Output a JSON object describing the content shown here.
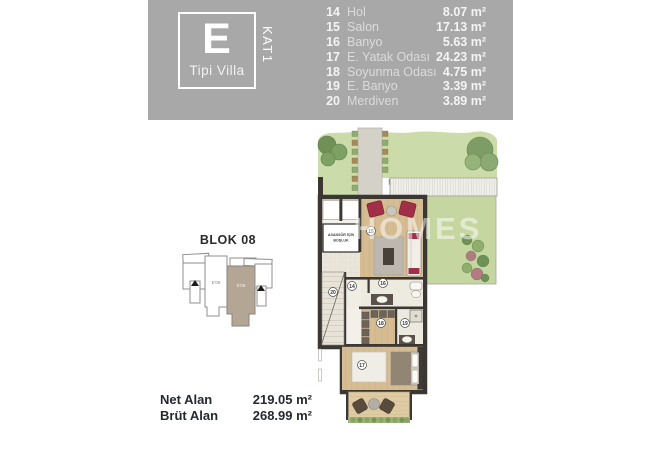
{
  "title_block": {
    "type_letter": "E",
    "type_label": "Tipi Villa",
    "floor_label": "KAT1"
  },
  "room_schedule": [
    {
      "no": "14",
      "name": "Hol",
      "area": "8.07 m²"
    },
    {
      "no": "15",
      "name": "Salon",
      "area": "17.13 m²"
    },
    {
      "no": "16",
      "name": "Banyo",
      "area": "5.63 m²"
    },
    {
      "no": "17",
      "name": "E. Yatak Odası",
      "area": "24.23 m²"
    },
    {
      "no": "18",
      "name": "Soyunma Odası",
      "area": "4.75 m²"
    },
    {
      "no": "19",
      "name": "E. Banyo",
      "area": "3.39 m²"
    },
    {
      "no": "20",
      "name": "Merdiven",
      "area": "3.89 m²"
    }
  ],
  "site_plan": {
    "title": "BLOK 08",
    "unit_label_left": "E'08",
    "unit_label_right": "E'08"
  },
  "area_summary": {
    "net_label": "Net Alan",
    "net_value": "219.05 m²",
    "brut_label": "Brüt Alan",
    "brut_value": "268.99 m²"
  },
  "floor_plan": {
    "elevator_note_line1": "ASANSÖR İÇİN",
    "elevator_note_line2": "BOŞLUK",
    "watermark": "HOMES",
    "markers": {
      "hol": "14",
      "salon": "15",
      "banyo": "16",
      "yatak": "17",
      "soyunma": "18",
      "ebanyo": "19",
      "merdiven": "20"
    }
  },
  "colors": {
    "banner_gray": "#a8a8a8",
    "wall_dark": "#3b3733",
    "lawn_green": "#cbdcaa",
    "wood_floor": "#d6bc93",
    "accent_red": "#a12f47",
    "site_highlight": "#b4a694",
    "text_dark": "#24282f"
  }
}
